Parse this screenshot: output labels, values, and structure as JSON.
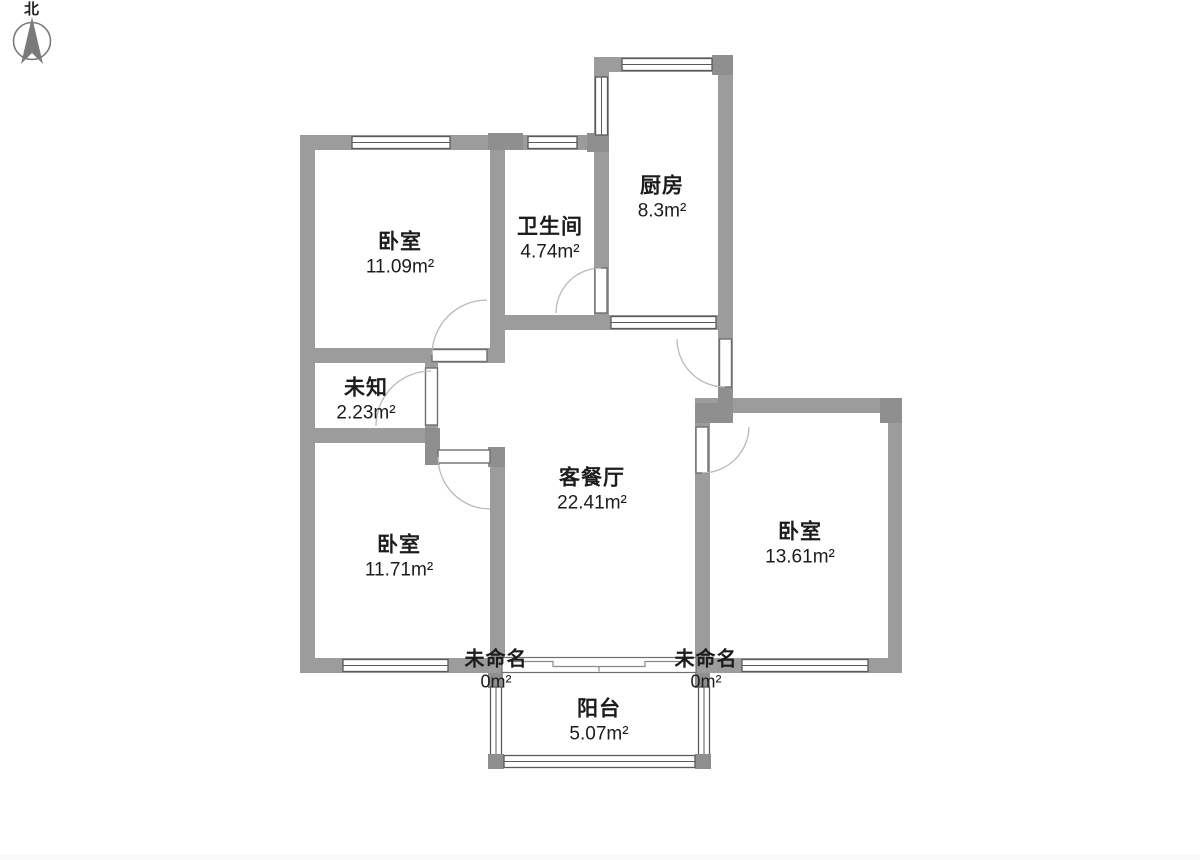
{
  "compass": {
    "label": "北"
  },
  "colors": {
    "wall": "#9c9c9c",
    "wall_dark": "#8f8f8f",
    "opening_outline": "#5a5a5a",
    "door_arc": "#b9b9b9",
    "label_text": "#1c1c1c"
  },
  "rooms": [
    {
      "id": "bedroom-top",
      "name": "卧室",
      "area": "11.09m²"
    },
    {
      "id": "bathroom",
      "name": "卫生间",
      "area": "4.74m²"
    },
    {
      "id": "kitchen",
      "name": "厨房",
      "area": "8.3m²"
    },
    {
      "id": "unknown",
      "name": "未知",
      "area": "2.23m²"
    },
    {
      "id": "living-dining",
      "name": "客餐厅",
      "area": "22.41m²"
    },
    {
      "id": "bedroom-left",
      "name": "卧室",
      "area": "11.71m²"
    },
    {
      "id": "bedroom-right",
      "name": "卧室",
      "area": "13.61m²"
    },
    {
      "id": "unnamed-left",
      "name": "未命名",
      "area": "0m²"
    },
    {
      "id": "unnamed-right",
      "name": "未命名",
      "area": "0m²"
    },
    {
      "id": "balcony",
      "name": "阳台",
      "area": "5.07m²"
    }
  ]
}
